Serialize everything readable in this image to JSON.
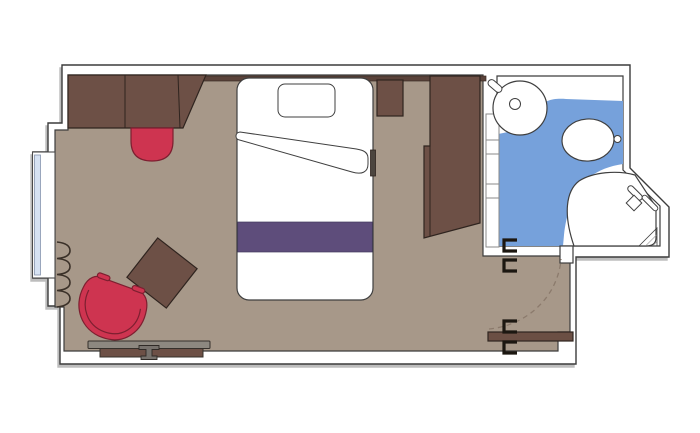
{
  "document": {
    "type": "floor-plan",
    "subject": "Ship cabin floor plan: living/sleeping area with balcony window, wardrobe, desk, and en-suite bathroom",
    "visible_text": ""
  },
  "colors": {
    "background": "#ffffff",
    "wall_fill": "#ffffff",
    "floor": "#a79889",
    "furniture_brown": "#6d5046",
    "trim_dark_brown": "#5a423a",
    "accent_red": "#ce3450",
    "bed_white": "#ffffff",
    "runner_purple": "#5e4d7b",
    "bathroom_blue": "#76a1db",
    "fixture_white": "#ffffff",
    "window_glass": "#d6e2f3",
    "desk_gray": "#8d8880",
    "stool_gray": "#77726d",
    "door_leaf_brown": "#6b4f44",
    "side_shelf_dark": "#4c453f"
  },
  "rooms": {
    "cabin": {
      "furniture": [
        "sofa",
        "coffee-table",
        "single-bed",
        "pillow",
        "duvet-fold",
        "bed-runner",
        "nightstand",
        "wardrobe",
        "armchair",
        "side-table",
        "desk",
        "stool",
        "curtain",
        "window"
      ]
    },
    "bathroom": {
      "fixtures": [
        "washbasin",
        "faucet",
        "toilet",
        "flush-button",
        "shower",
        "shower-head",
        "shelf-unit"
      ],
      "floor_color_ref": "bathroom_blue"
    },
    "entry": {
      "elements": [
        "entry-door",
        "door-swing-arc",
        "door-hinges",
        "bathroom-door-hinges"
      ]
    }
  }
}
